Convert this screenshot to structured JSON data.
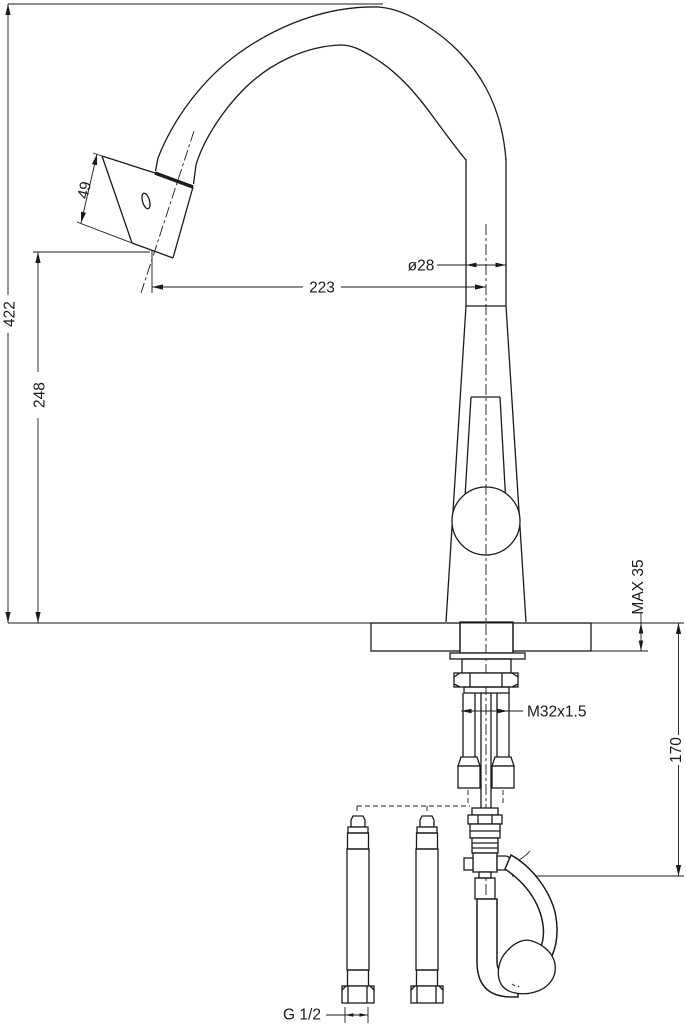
{
  "dimensions": {
    "spray_head_length": "49",
    "total_height": "422",
    "height_to_spout_outlet": "248",
    "spout_reach": "223",
    "spout_diameter": "ø28",
    "max_countertop_thickness": "MAX 35",
    "mounting_thread": "M32x1.5",
    "hose_drop_length": "170",
    "supply_connection_thread": "G 1/2"
  },
  "colors": {
    "line": "#1a1a1a",
    "background": "#ffffff"
  }
}
